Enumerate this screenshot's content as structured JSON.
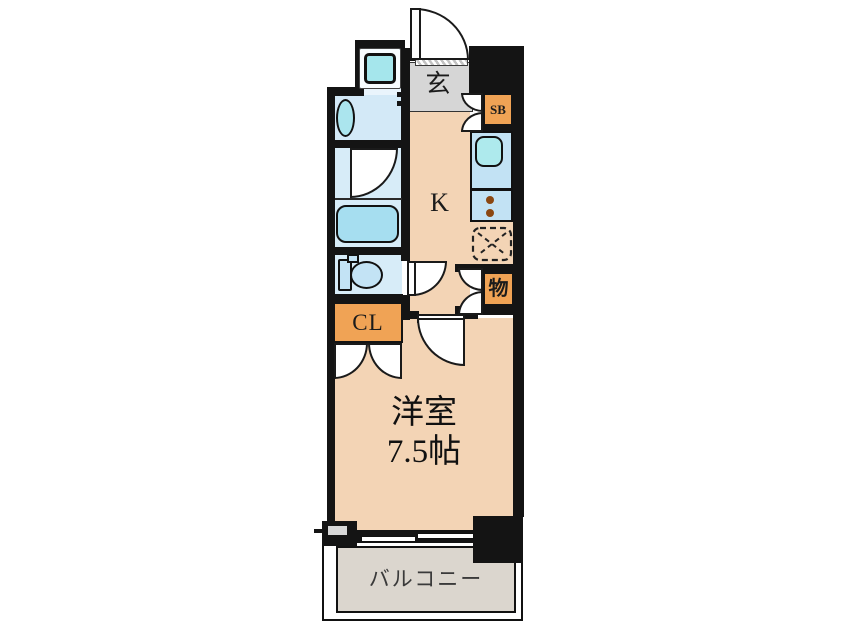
{
  "floorplan": {
    "type_note": "1K apartment floor plan",
    "rooms": {
      "genkan": {
        "label": "玄"
      },
      "shoe_box": {
        "label": "SB"
      },
      "kitchen": {
        "label": "K"
      },
      "storage": {
        "label": "物"
      },
      "closet": {
        "label": "CL"
      },
      "western_room": {
        "label": "洋室",
        "size": "7.5帖"
      },
      "balcony": {
        "label": "バルコニー"
      }
    },
    "colors": {
      "wall": "#141414",
      "room_floor_peach": "#F3D4B5",
      "accent_orange": "#F0A355",
      "wet_area_blue": "#D7ECF8",
      "fixture_teal": "#A9E6EC",
      "kitchen_counter_blue": "#C2E2F4",
      "genkan_gray": "#D6D6D6",
      "balcony_gray": "#DBD6CE",
      "burner_brown": "#8B4711"
    }
  }
}
